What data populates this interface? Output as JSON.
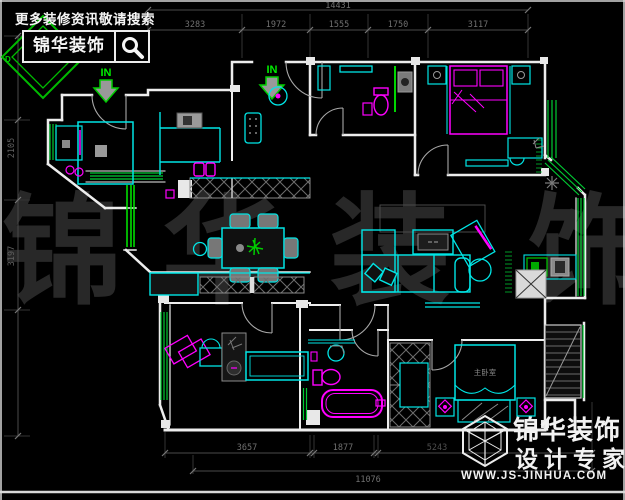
{
  "colors": {
    "background": "#000000",
    "wall_white": "#ededed",
    "fixture_cyan": "#00e5e5",
    "window_green": "#00cc33",
    "accent_magenta": "#ff00ff",
    "dimension_gray": "#707070",
    "watermark_gray": "#282828",
    "brand_white": "#f2f2f2"
  },
  "header_brand": {
    "tagline": "更多装修资讯敬请搜索",
    "name": "锦华装饰",
    "logo_letter": "D",
    "search_icon": "magnifier-icon"
  },
  "footer_brand": {
    "name": "锦华装饰",
    "subtitle": "设计专家",
    "url": "WWW.JS-JINHUA.COM",
    "logo_icon": "cube-wireframe-icon"
  },
  "watermark": [
    "锦",
    "华",
    "装",
    "饰"
  ],
  "plan_labels": {
    "entry_in_1": "IN",
    "entry_in_2": "IN",
    "master_bed": "主卧室"
  },
  "dimensions": {
    "top_total": "14431",
    "top_segments": [
      "3283",
      "1972",
      "1555",
      "1750",
      "3117"
    ],
    "left_segments": [
      "2105",
      "3197"
    ],
    "bottom_segments": [
      "3657",
      "1877",
      "5243"
    ],
    "bottom_total": "11076"
  }
}
